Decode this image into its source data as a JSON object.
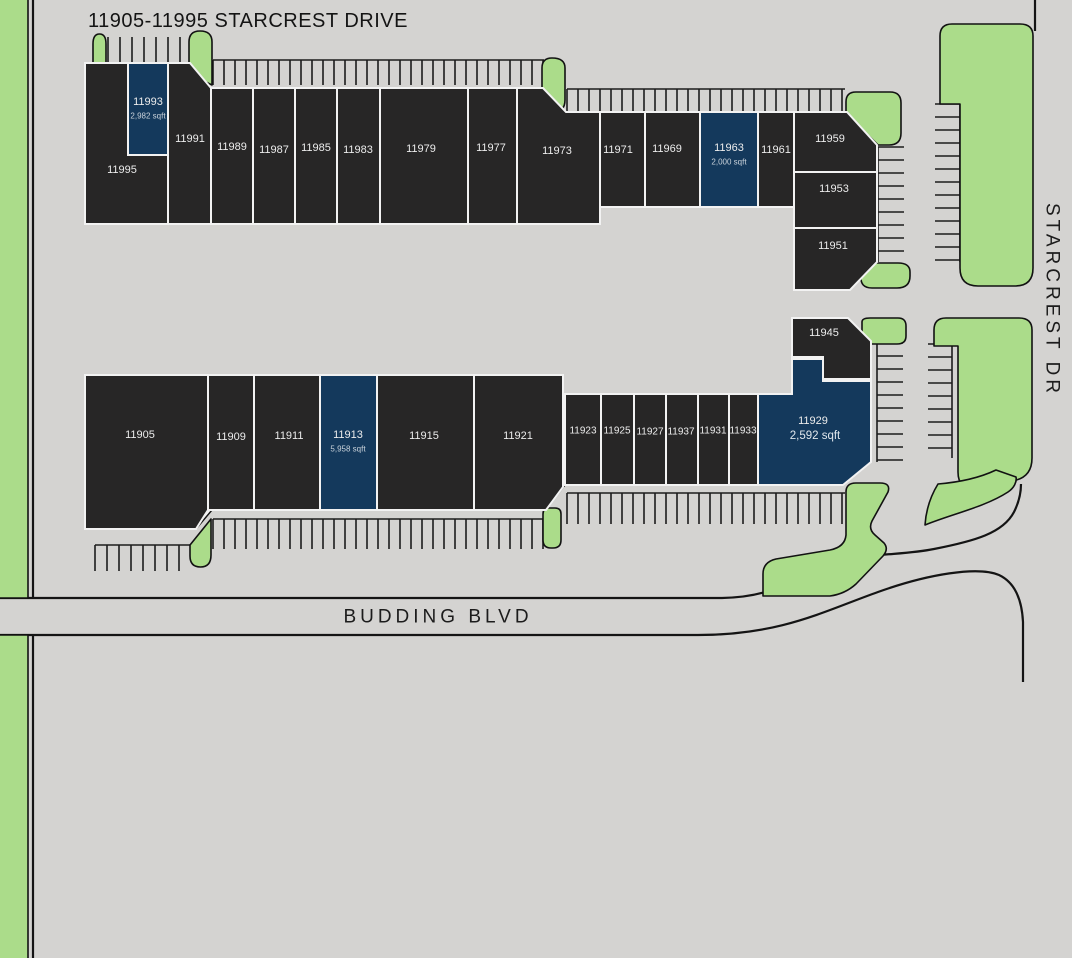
{
  "title": "11905-11995 STARCREST DRIVE",
  "streets": {
    "right_vertical": "STARCREST DR",
    "bottom": "BUDDING BLVD"
  },
  "colors": {
    "background": "#d4d3d1",
    "building": "#272626",
    "highlight": "#14395c",
    "landscape": "#abdc8a",
    "outline": "#121212",
    "building_border": "#fafafa",
    "unit_label": "#ececec",
    "sqft_label": "#c9d2da",
    "street_label": "#1c1c1c"
  },
  "units": [
    {
      "id": "11995"
    },
    {
      "id": "11993",
      "sqft": "2,982 sqft",
      "highlighted": true
    },
    {
      "id": "11991"
    },
    {
      "id": "11989"
    },
    {
      "id": "11987"
    },
    {
      "id": "11985"
    },
    {
      "id": "11983"
    },
    {
      "id": "11979"
    },
    {
      "id": "11977"
    },
    {
      "id": "11973"
    },
    {
      "id": "11971"
    },
    {
      "id": "11969"
    },
    {
      "id": "11963",
      "sqft": "2,000 sqft",
      "highlighted": true
    },
    {
      "id": "11961"
    },
    {
      "id": "11959"
    },
    {
      "id": "11953"
    },
    {
      "id": "11951"
    },
    {
      "id": "11905"
    },
    {
      "id": "11909"
    },
    {
      "id": "11911"
    },
    {
      "id": "11913",
      "sqft": "5,958 sqft",
      "highlighted": true
    },
    {
      "id": "11915"
    },
    {
      "id": "11921"
    },
    {
      "id": "11923"
    },
    {
      "id": "11925"
    },
    {
      "id": "11927"
    },
    {
      "id": "11937"
    },
    {
      "id": "11931"
    },
    {
      "id": "11933"
    },
    {
      "id": "11929",
      "sqft": "2,592 sqft",
      "highlighted": true
    },
    {
      "id": "11945"
    }
  ]
}
